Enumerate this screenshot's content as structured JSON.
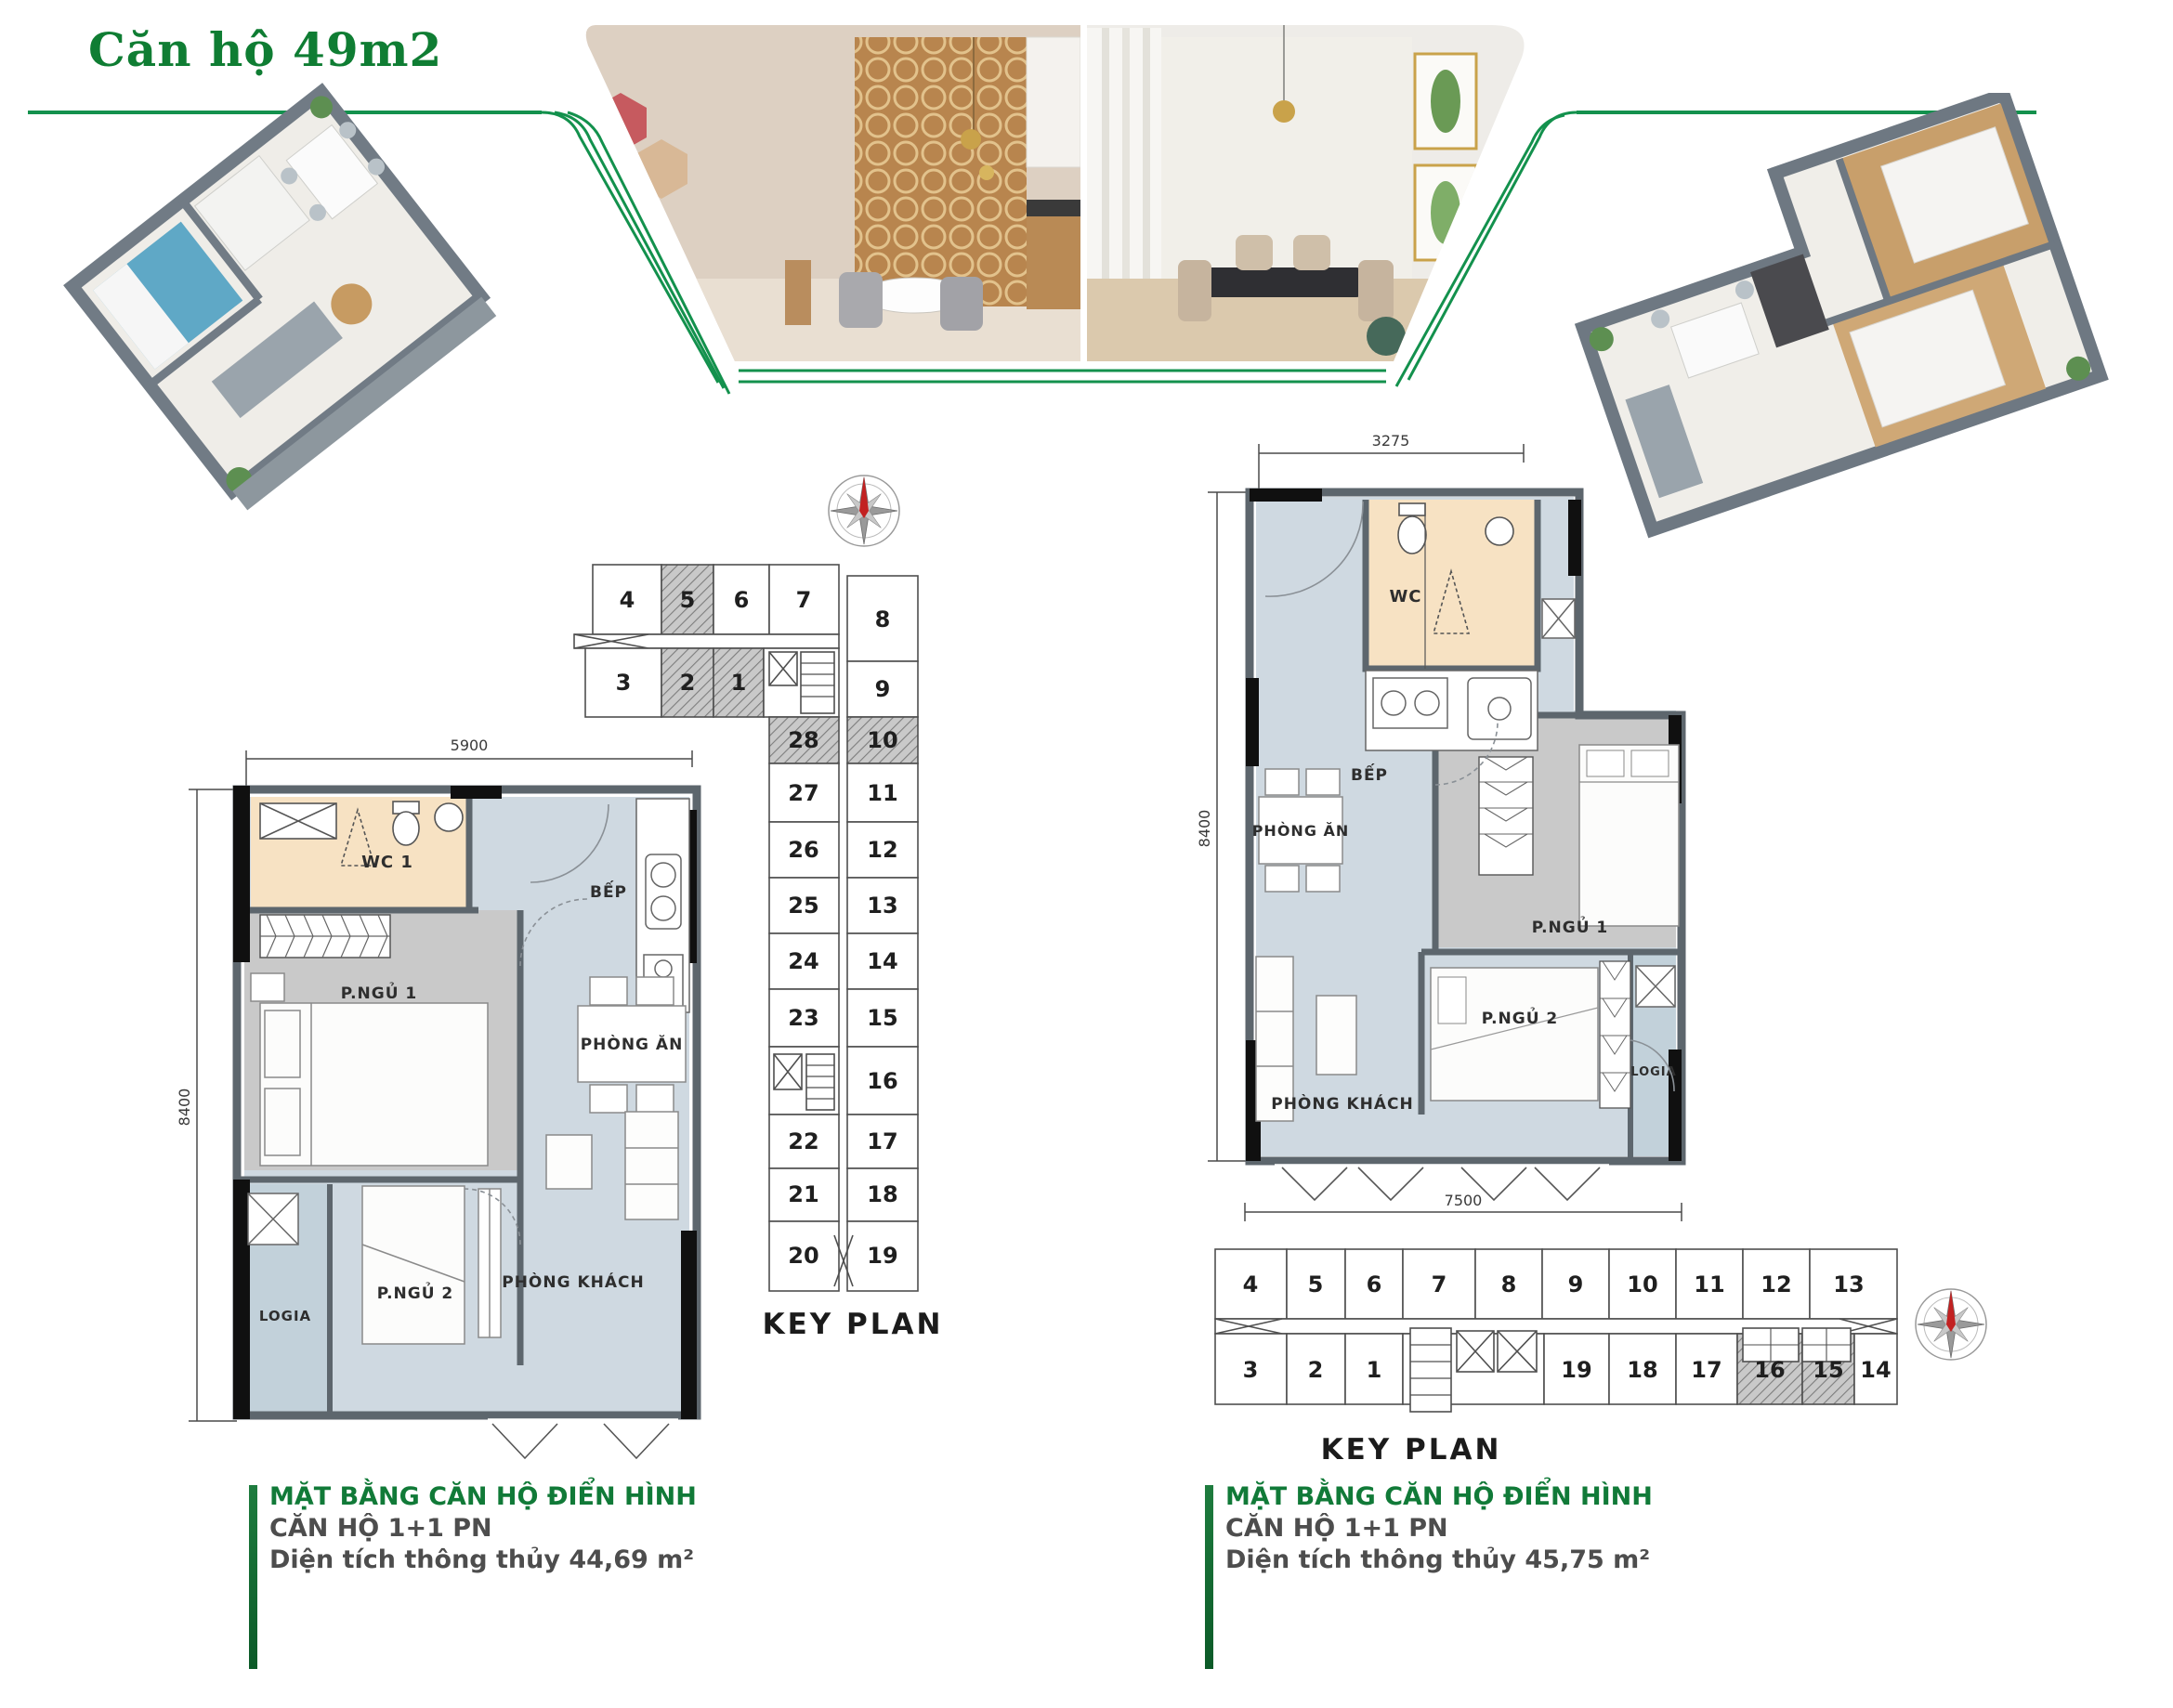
{
  "title": "Căn hộ 49m2",
  "key_plan_label": "KEY PLAN",
  "icons": {
    "compass": "compass-rose-icon",
    "photos": [
      "kitchen-dining-render-photo",
      "living-dining-render-photo"
    ],
    "renders": [
      "apartment-3d-isometric-left",
      "apartment-3d-isometric-right"
    ]
  },
  "colors": {
    "brand_green": "#117a38",
    "line_green": "#13914d",
    "caption_gray": "#4d4d4d",
    "floor_blue": "#cfd9e1",
    "floor_gray": "#c9c9c9",
    "wc_beige": "#f7e2c3",
    "logia_blue": "#c2d1da",
    "wall_gray": "#5d666d"
  },
  "plan_left": {
    "dim_top": "5900",
    "dim_left": "8400",
    "rooms": {
      "wc": "WC 1",
      "bedroom1": "P.NGỦ 1",
      "kitchen": "BẾP",
      "dining": "PHÒNG ĂN",
      "bedroom2": "P.NGỦ 2",
      "logia": "LOGIA",
      "living": "PHÒNG KHÁCH"
    },
    "caption": [
      "MẶT BẰNG CĂN HỘ ĐIỂN HÌNH",
      "CĂN HỘ 1+1 PN",
      "Diện tích thông thủy 44,69 m²"
    ]
  },
  "plan_right": {
    "dim_top": "3275",
    "dim_left": "8400",
    "dim_bottom": "7500",
    "rooms": {
      "wc": "WC",
      "bedroom1": "P.NGỦ 1",
      "kitchen": "BẾP",
      "dining": "PHÒNG ĂN",
      "bedroom2": "P.NGỦ 2",
      "logia": "LOGIA",
      "living": "PHÒNG KHÁCH"
    },
    "caption": [
      "MẶT BẰNG CĂN HỘ ĐIỂN HÌNH",
      "CĂN HỘ 1+1 PN",
      "Diện tích thông thủy 45,75 m²"
    ]
  },
  "keyplan_left": {
    "numbers": [
      "4",
      "5",
      "6",
      "7",
      "3",
      "2",
      "1",
      "8",
      "9",
      "28",
      "10",
      "27",
      "11",
      "26",
      "12",
      "25",
      "13",
      "24",
      "14",
      "23",
      "15",
      "16",
      "22",
      "17",
      "21",
      "18",
      "20",
      "19"
    ]
  },
  "keyplan_right": {
    "numbers": [
      "4",
      "5",
      "6",
      "7",
      "8",
      "9",
      "10",
      "11",
      "12",
      "13",
      "3",
      "2",
      "1",
      "19",
      "18",
      "17",
      "16",
      "15",
      "14"
    ]
  }
}
